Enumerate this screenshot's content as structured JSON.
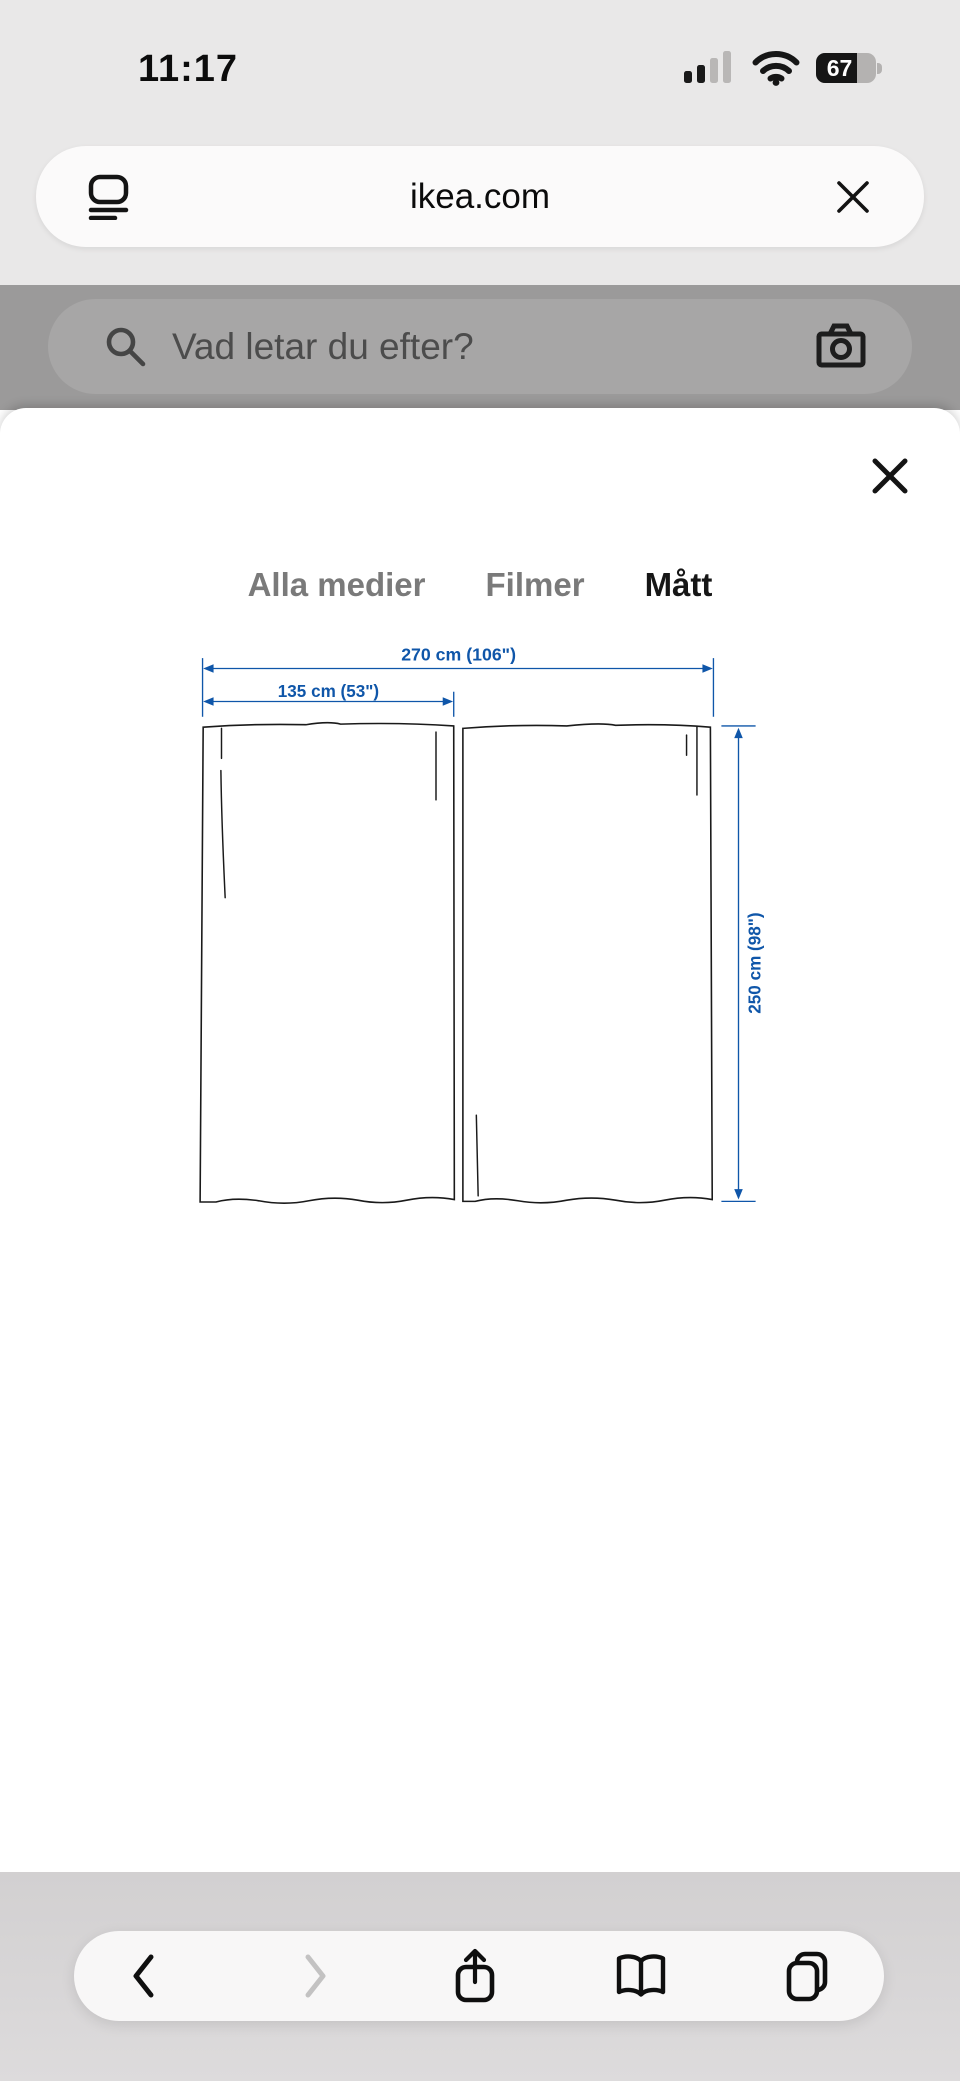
{
  "status_bar": {
    "time": "11:17",
    "battery_percent": "67"
  },
  "browser": {
    "url": "ikea.com",
    "toolbar": {
      "back": "back",
      "forward": "forward",
      "share": "share",
      "bookmarks": "bookmarks",
      "tabs": "tabs"
    }
  },
  "search": {
    "placeholder": "Vad letar du efter?"
  },
  "modal": {
    "tabs": [
      {
        "label": "Alla medier",
        "active": false
      },
      {
        "label": "Filmer",
        "active": false
      },
      {
        "label": "Mått",
        "active": true
      }
    ]
  },
  "diagram": {
    "product": "curtain pair, two panels",
    "total_width": "270 cm (106\")",
    "panel_width": "135 cm (53\")",
    "height": "250 cm (98\")"
  },
  "icons": {
    "page_menu": "page-menu-icon",
    "close_url": "close-icon",
    "search": "search-icon",
    "camera": "camera-icon",
    "close_modal": "close-icon",
    "signal": "cellular-signal-icon",
    "wifi": "wifi-icon",
    "battery": "battery-icon"
  },
  "colors": {
    "accent_blue": "#0f56a9",
    "chrome_bg": "#e9e8e8",
    "dim_bg": "#9b9a9a",
    "line": "#191919"
  }
}
